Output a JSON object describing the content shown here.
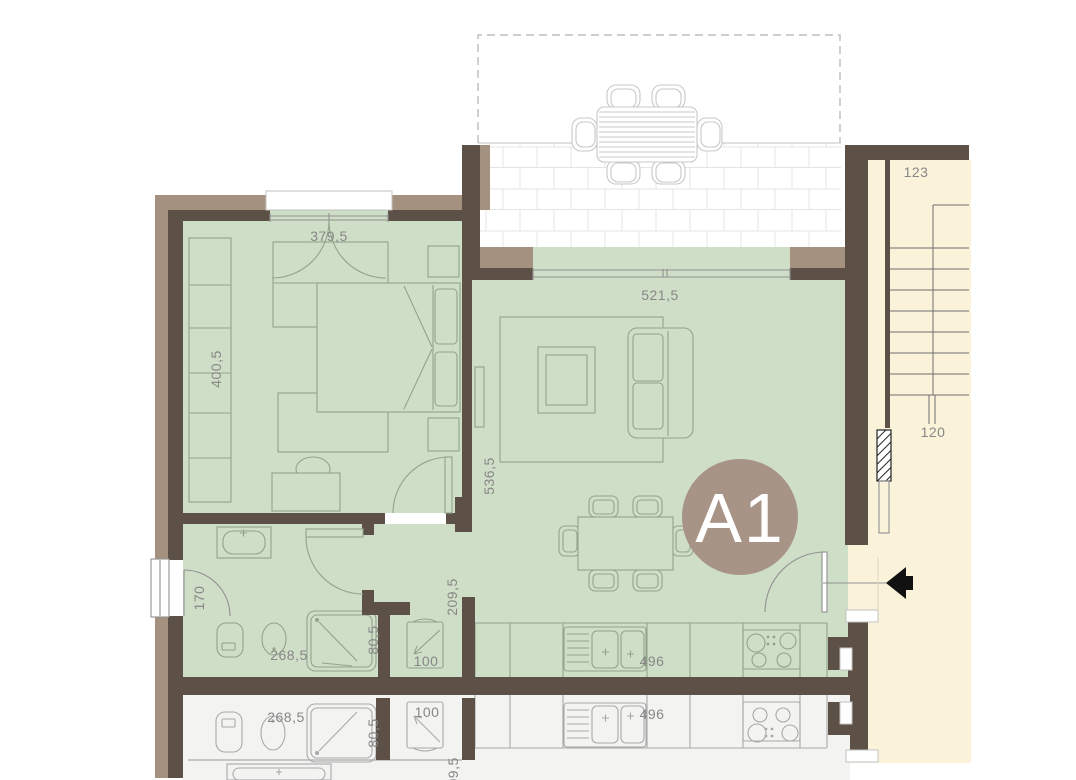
{
  "unit_badge": {
    "label": "A1"
  },
  "dims": {
    "bedroom_door_width": "379,5",
    "bedroom_depth": "400,5",
    "living_width": "521,5",
    "living_depth": "536,5",
    "hall_depth": "209,5",
    "bathroom_window_width": "170",
    "bathroom_width": "268,5",
    "shower_width": "80,5",
    "washer_niche_width": "100",
    "kitchen_run_length": "496",
    "stair_label_upper": "123",
    "stair_label_lower": "120"
  },
  "lower_unit_dims": {
    "bathroom_width": "268,5",
    "shower_width": "80,5",
    "washer_niche_width": "100",
    "kitchen_run_length": "496",
    "hall_depth": "209,5"
  },
  "colors": {
    "background": "#ffffff",
    "wall_dark": "#5d5047",
    "wall_taupe": "#a4917f",
    "room_green": "#cfdec7",
    "furniture_green_line": "#93a38c",
    "stairs_cream": "#faf3da",
    "stair_line": "#6f6f6f",
    "terrace_line": "#c8c8c8",
    "tile_line": "#e4e4e4",
    "lower_floor": "#f3f3f1",
    "lower_line": "#a9a9a9",
    "door_gray": "#919191",
    "slab_line": "#c2c2c2",
    "dash_line": "#bdbdbd",
    "dim_text": "#878787",
    "badge_fill": "#a89387",
    "badge_text": "#ffffff",
    "entrance_arrow": "#111111",
    "hatch_line": "#222222"
  }
}
